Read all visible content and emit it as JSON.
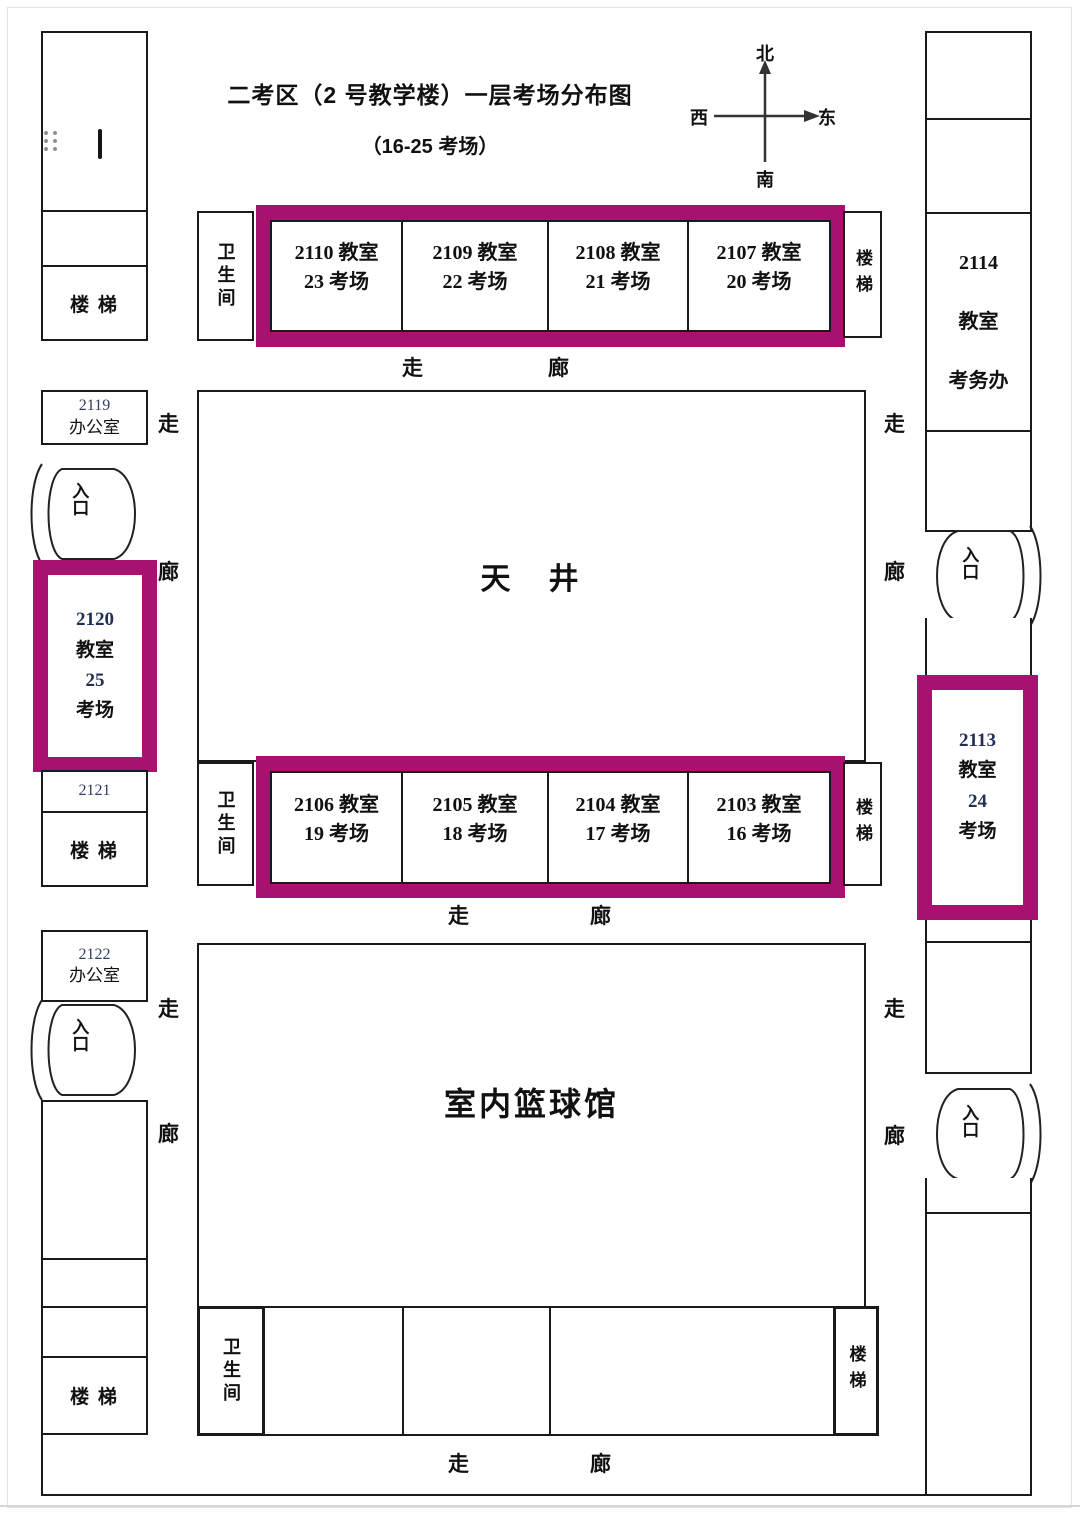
{
  "header": {
    "title": "二考区（2 号教学楼）一层考场分布图",
    "subtitle": "（16-25 考场）"
  },
  "compass": {
    "north": "北",
    "south": "南",
    "west": "西",
    "east": "东"
  },
  "corridors": {
    "zou": "走",
    "lang": "廊"
  },
  "common": {
    "stairs_h": "楼 梯",
    "stairs_v": "楼梯",
    "toilet": "卫生间",
    "entrance": "入口"
  },
  "courtyard": {
    "label": "天　井"
  },
  "gym": {
    "label": "室内篮球馆"
  },
  "exam_rooms_top": [
    {
      "room": "2110 教室",
      "session": "23 考场"
    },
    {
      "room": "2109 教室",
      "session": "22 考场"
    },
    {
      "room": "2108 教室",
      "session": "21 考场"
    },
    {
      "room": "2107 教室",
      "session": "20 考场"
    }
  ],
  "exam_rooms_middle": [
    {
      "room": "2106 教室",
      "session": "19 考场"
    },
    {
      "room": "2105 教室",
      "session": "18 考场"
    },
    {
      "room": "2104 教室",
      "session": "17 考场"
    },
    {
      "room": "2103 教室",
      "session": "16 考场"
    }
  ],
  "west_wing": {
    "office_2119": {
      "number": "2119",
      "name": "办公室"
    },
    "room_2120": {
      "number": "2120",
      "line2": "教室",
      "line3": "25",
      "line4": "考场"
    },
    "room_2121": {
      "number": "2121"
    },
    "office_2122": {
      "number": "2122",
      "name": "办公室"
    }
  },
  "east_wing": {
    "room_2114": {
      "number": "2114",
      "line2": "教室",
      "line3": "考务办"
    },
    "room_2113": {
      "number": "2113",
      "line2": "教室",
      "line3": "24",
      "line4": "考场"
    }
  },
  "colors": {
    "highlight": "#a81170",
    "wall": "#1a1a1a",
    "text": "#111111"
  }
}
